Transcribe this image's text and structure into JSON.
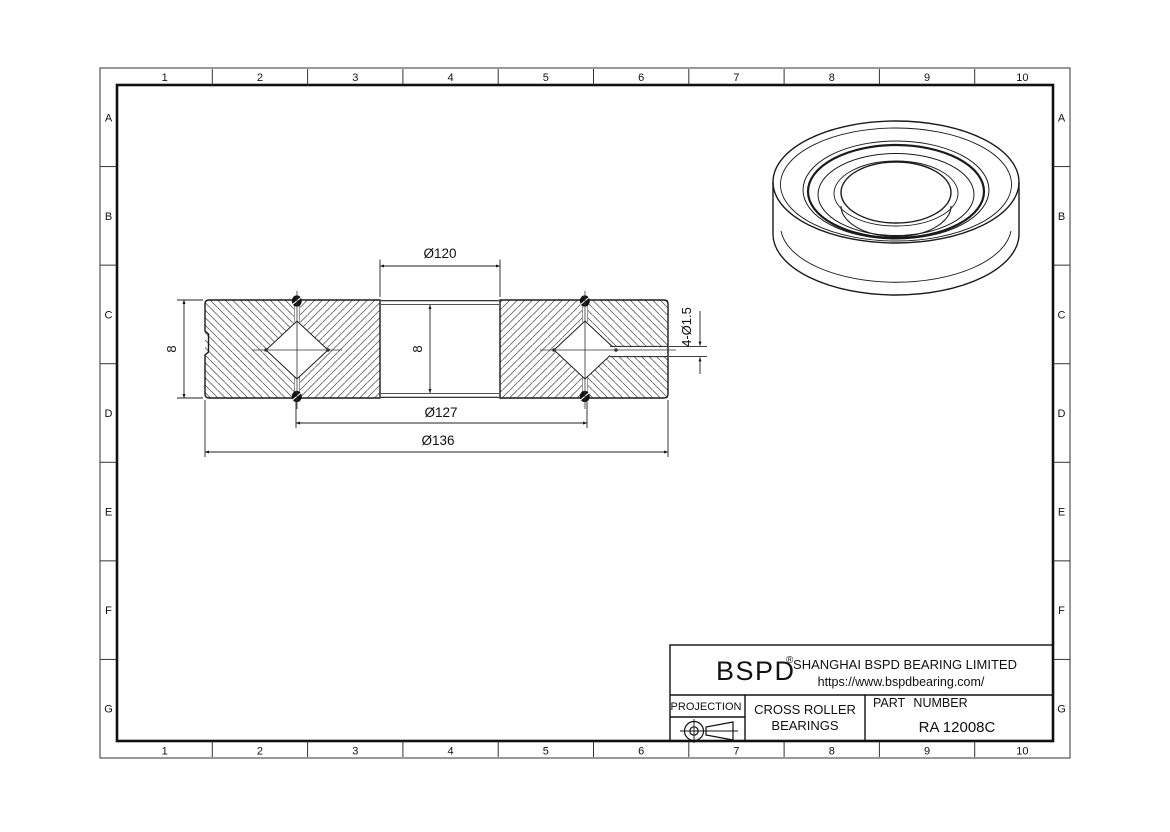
{
  "frame": {
    "columns": [
      "1",
      "2",
      "3",
      "4",
      "5",
      "6",
      "7",
      "8",
      "9",
      "10"
    ],
    "rows": [
      "A",
      "B",
      "C",
      "D",
      "E",
      "F",
      "G"
    ]
  },
  "section_view": {
    "dimensions": {
      "bore_diameter": "Ø120",
      "pitch_diameter": "Ø127",
      "outer_diameter": "Ø136",
      "width_left": "8",
      "width_center": "8",
      "grease_holes": "4-Ø1.5"
    }
  },
  "title_block": {
    "brand": "BSPD",
    "registered_mark": "®",
    "company": "SHANGHAI BSPD BEARING LIMITED",
    "website": "https://www.bspdbearing.com/",
    "projection_label": "PROJECTION",
    "product_line1": "CROSS ROLLER",
    "product_line2": "BEARINGS",
    "part_number_label": "PART NUMBER",
    "part_number": "RA 12008C"
  },
  "colors": {
    "line": "#1a1a1a",
    "hatch": "#4a4a4a",
    "background": "#ffffff"
  }
}
